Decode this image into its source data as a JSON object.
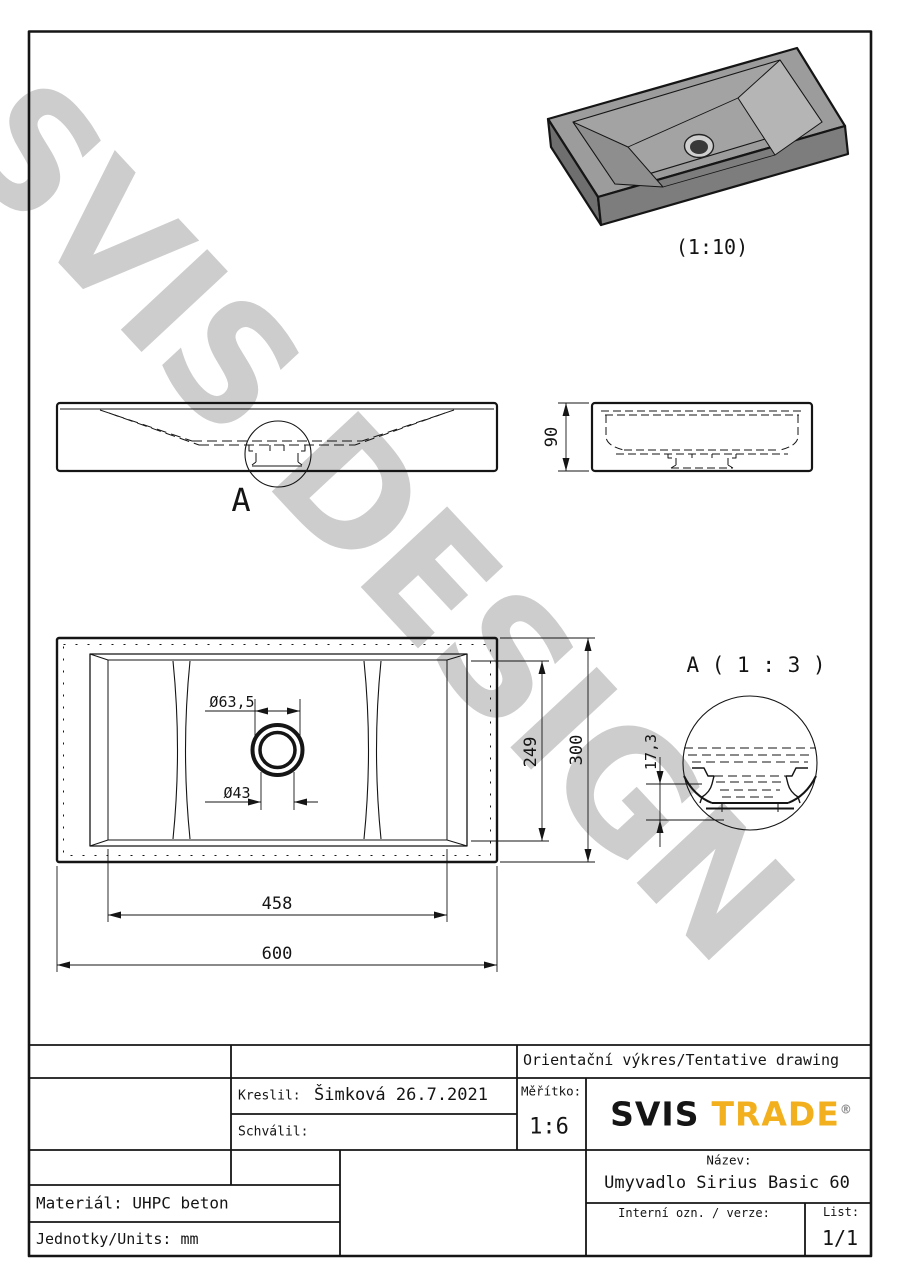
{
  "watermark": {
    "text": "SVIS DESIGN",
    "color": "#cdcdcd"
  },
  "iso_view": {
    "scale_label": "(1:10)"
  },
  "front_view": {
    "detail_marker": "A"
  },
  "dimensions": {
    "height": "90",
    "drain_outer_diameter": "Ø63,5",
    "drain_inner_diameter": "Ø43",
    "basin_length": "249",
    "depth": "300",
    "basin_width": "458",
    "width": "600",
    "detail_recess_depth": "17,3"
  },
  "detail_view": {
    "title": "A ( 1 : 3 )"
  },
  "title_block": {
    "document_type": "Orientační výkres/Tentative drawing",
    "drawn_by_label": "Kreslil:",
    "drawn_by_value": "Šimková 26.7.2021",
    "approved_by_label": "Schválil:",
    "scale_label": "Měřítko:",
    "scale_value": "1:6",
    "logo": {
      "text_primary": "SVIS",
      "text_secondary": "TRADE",
      "registered_mark": "®",
      "accent_color": "#f2b01e"
    },
    "name_label": "Název:",
    "name_value": "Umyvadlo Sirius Basic 60",
    "internal_id_label": "Interní ozn. / verze:",
    "sheet_label": "List:",
    "sheet_value": "1/1",
    "material": "Materiál: UHPC beton",
    "units": "Jednotky/Units: mm"
  }
}
